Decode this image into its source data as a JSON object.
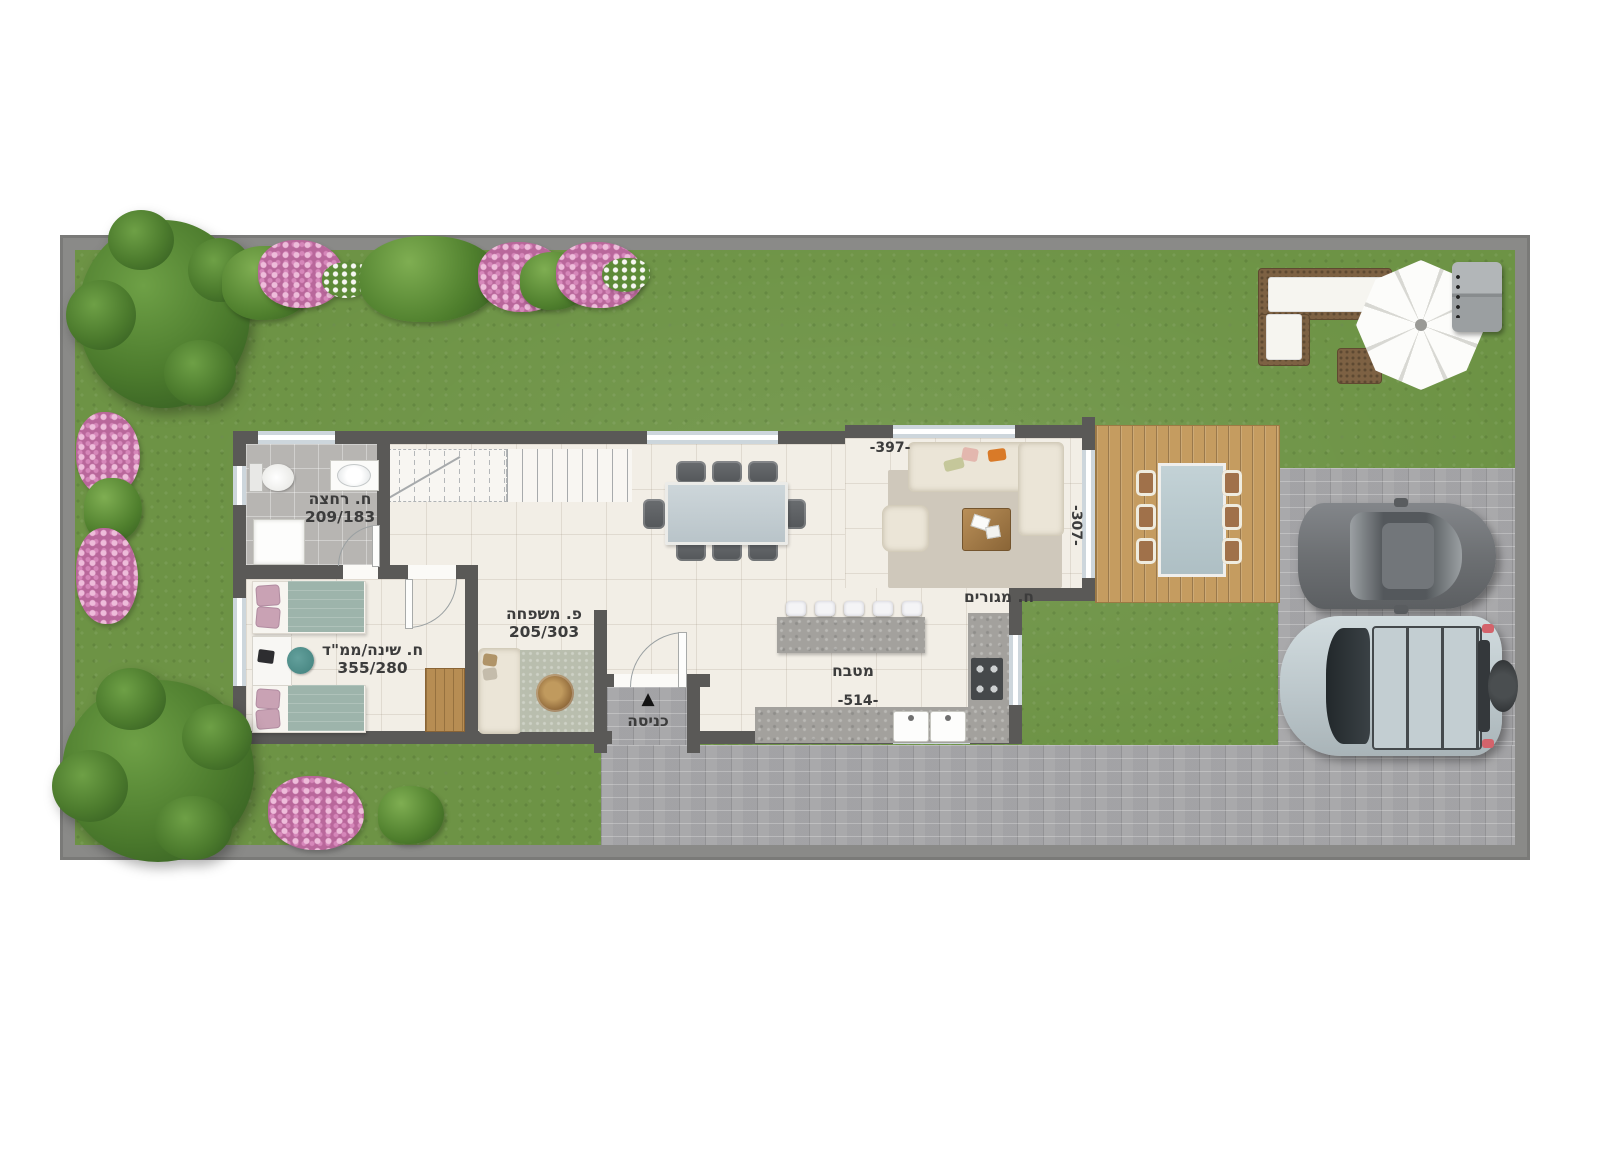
{
  "plan": {
    "bathroom": {
      "label": "ח. רחצה",
      "size": "209/183"
    },
    "bedroom": {
      "label": "ח. שינה/ממ\"ד",
      "size": "355/280"
    },
    "family_room": {
      "label": "פ. משפחה",
      "size": "205/303"
    },
    "living_room": {
      "label": "ח. מגורים"
    },
    "kitchen": {
      "label": "מטבח",
      "width": "-514-"
    },
    "entrance": {
      "label": "כניסה"
    },
    "dimensions": {
      "top_width": "-397-",
      "side_depth": "-307-"
    }
  },
  "icons": {
    "entrance_arrow": "▲"
  },
  "colors": {
    "grass": "#6d9345",
    "plot_wall": "#8a8a88",
    "house_wall": "#5a5957",
    "pavers": "#a9a9ab",
    "deck": "#c59c60",
    "floor": "#f2eee6",
    "bath_floor": "#b7b5b2",
    "window_glass": "#cdd6dc",
    "label_text": "#3c3c3c",
    "granite": "#a3a19d",
    "sofa": "#ebe5d7",
    "rug_living": "#cfc8bb",
    "rug_family": "#b9beae",
    "wood": "#b78d53",
    "bedding_teal": "#9db4ab",
    "bedding_pink": "#c9a2b4",
    "car_sedan": "#73767a",
    "car_suv": "#c6d1d5",
    "umbrella": "#fbfbf9"
  }
}
